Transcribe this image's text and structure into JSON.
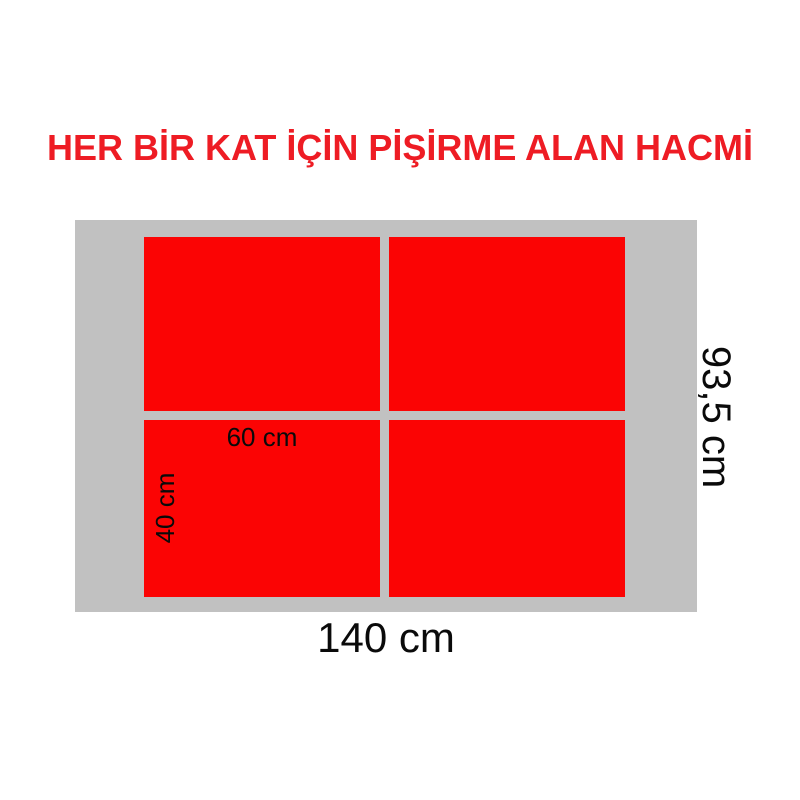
{
  "title": {
    "text": "HER BİR KAT İÇİN PİŞİRME ALAN HACMİ"
  },
  "diagram": {
    "tray": {
      "width_label": "140 cm",
      "height_label": "93,5 cm"
    },
    "zone": {
      "width_label": "60 cm",
      "height_label": "40 cm"
    },
    "zone_count": 4
  },
  "colors": {
    "title-red": "#ee1c24",
    "zone-red": "#fb0404",
    "tray-gray": "#c1c1c1",
    "label-black": "#0a0a0a",
    "page-bg": "#ffffff"
  }
}
